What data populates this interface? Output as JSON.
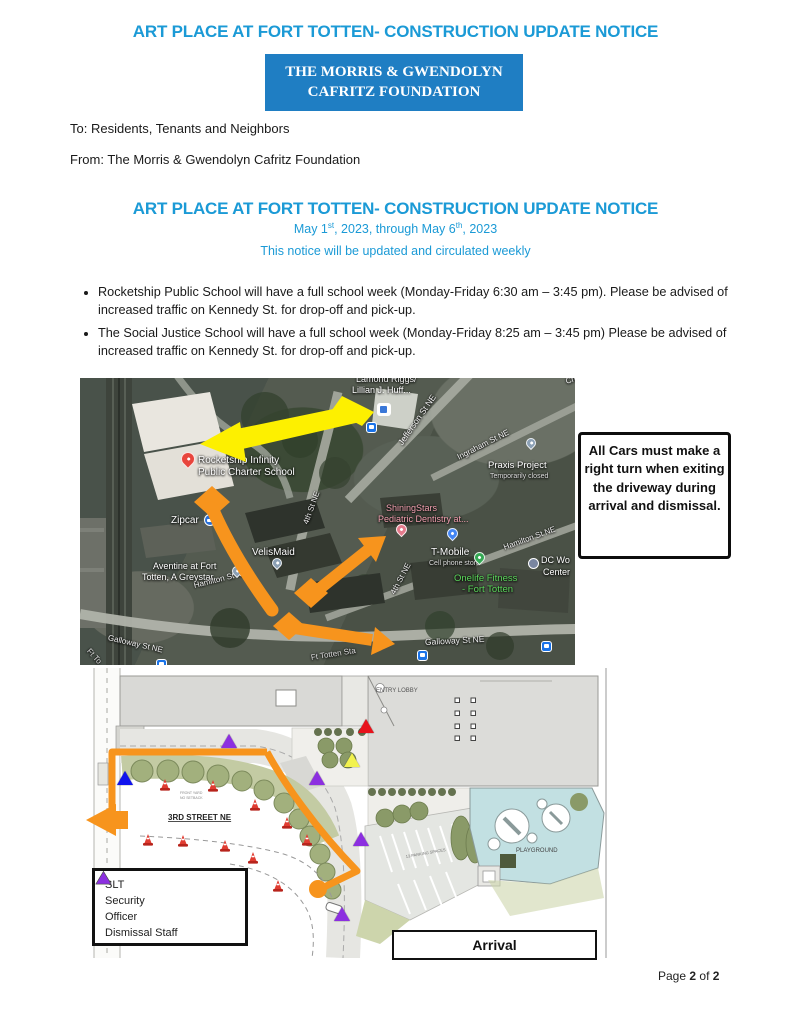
{
  "doc": {
    "title": "ART PLACE AT FORT TOTTEN- CONSTRUCTION UPDATE NOTICE"
  },
  "header": {
    "org_line1": "THE MORRIS & GWENDOLYN",
    "org_line2": "CAFRITZ FOUNDATION",
    "to_line": "To: Residents, Tenants and Neighbors",
    "from_line": "From: The Morris & Gwendolyn Cafritz Foundation"
  },
  "notice": {
    "date": {
      "p1": "May 1",
      "s1": "st",
      "p2": ", 2023, through May 6",
      "s2": "th",
      "p3": ", 2023"
    },
    "subtitle": "This notice will be updated and circulated weekly"
  },
  "bullets": [
    "Rocketship Public School will have a full school week (Monday-Friday 6:30 am – 3:45 pm). Please be advised of increased traffic on Kennedy St. for drop-off and pick-up.",
    "The Social Justice School will have a full school week (Monday-Friday 8:25 am – 3:45 pm) Please be advised of increased traffic on Kennedy St. for drop-off and pick-up."
  ],
  "colors": {
    "title_blue": "#1B9AD6",
    "banner_blue": "#1F7EC3",
    "route_orange": "#F7941D",
    "route_yellow": "#FDF000",
    "playground_blue": "#C2E0E2"
  },
  "map": {
    "labels": [
      {
        "text": "Lamond Riggs/",
        "x": 276,
        "y": -3,
        "size": 9,
        "color": "#f2f2f2"
      },
      {
        "text": "Lillian J. Huff...",
        "x": 272,
        "y": 8,
        "size": 9,
        "color": "#fff"
      },
      {
        "text": "Jefferson St NE",
        "x": 320,
        "y": 62,
        "size": 8.5,
        "color": "#f2f2f2",
        "rotate": -55
      },
      {
        "text": "Ingraham St NE",
        "x": 378,
        "y": 76,
        "size": 8,
        "color": "#f2f2f2",
        "rotate": -27
      },
      {
        "text": "Praxis Project",
        "x": 408,
        "y": 83,
        "size": 9.5,
        "color": "#fff"
      },
      {
        "text": "Temporarily closed",
        "x": 410,
        "y": 95,
        "size": 7,
        "color": "#ddd"
      },
      {
        "text": "Chil",
        "x": 486,
        "y": 0,
        "size": 8,
        "color": "#eee",
        "rotate": -18
      },
      {
        "text": "Rocketship Infinity",
        "x": 118,
        "y": 78,
        "size": 10,
        "color": "#fff"
      },
      {
        "text": "Public Charter School",
        "x": 118,
        "y": 90,
        "size": 10,
        "color": "#fff"
      },
      {
        "text": "Zipcar",
        "x": 91,
        "y": 138,
        "size": 10,
        "color": "#fff"
      },
      {
        "text": "VelisMaid",
        "x": 172,
        "y": 170,
        "size": 10,
        "color": "#fff"
      },
      {
        "text": "Aventine at Fort",
        "x": 73,
        "y": 184,
        "size": 9,
        "color": "#fff"
      },
      {
        "text": "Totten, A Greystar...",
        "x": 62,
        "y": 195,
        "size": 9,
        "color": "#fff"
      },
      {
        "text": "ShiningStars",
        "x": 306,
        "y": 126,
        "size": 9,
        "color": "#F2A0B0"
      },
      {
        "text": "Pediatric Dentistry at...",
        "x": 298,
        "y": 137,
        "size": 9,
        "color": "#F2A0B0"
      },
      {
        "text": "4th St NE",
        "x": 226,
        "y": 142,
        "size": 8,
        "color": "#eee",
        "rotate": -70
      },
      {
        "text": "4th St NE",
        "x": 313,
        "y": 212,
        "size": 8,
        "color": "#eee",
        "rotate": -62
      },
      {
        "text": "T-Mobile",
        "x": 351,
        "y": 170,
        "size": 10,
        "color": "#fff"
      },
      {
        "text": "Cell phone store",
        "x": 349,
        "y": 182,
        "size": 7,
        "color": "#ddd"
      },
      {
        "text": "Onelife Fitness",
        "x": 374,
        "y": 196,
        "size": 9.5,
        "color": "#5BD75B"
      },
      {
        "text": "- Fort Totten",
        "x": 382,
        "y": 207,
        "size": 9.5,
        "color": "#5BD75B"
      },
      {
        "text": "DC Wo",
        "x": 461,
        "y": 178,
        "size": 9,
        "color": "#fff"
      },
      {
        "text": "Center",
        "x": 463,
        "y": 190,
        "size": 9,
        "color": "#fff"
      },
      {
        "text": "Hamilton St NE",
        "x": 424,
        "y": 166,
        "size": 8,
        "color": "#f2f2f2",
        "rotate": -20
      },
      {
        "text": "Hamilton St NE",
        "x": 114,
        "y": 204,
        "size": 8,
        "color": "#f2f2f2",
        "rotate": -14
      },
      {
        "text": "Galloway St NE",
        "x": 28,
        "y": 256,
        "size": 8,
        "color": "#f2f2f2",
        "rotate": 13
      },
      {
        "text": "Galloway St NE",
        "x": 345,
        "y": 260,
        "size": 8.5,
        "color": "#f2f2f2",
        "rotate": -3
      },
      {
        "text": "Ft Totten Sta",
        "x": 231,
        "y": 276,
        "size": 8,
        "color": "#ddd",
        "rotate": -9
      },
      {
        "text": "Ft To",
        "x": 8,
        "y": 268,
        "size": 8,
        "color": "#ddd",
        "rotate": 48
      }
    ],
    "pins": [
      {
        "name": "rocketship-pin",
        "color": "#E8453C",
        "x": 101,
        "y": 74,
        "size": 14
      },
      {
        "name": "praxis-pin",
        "color": "#8ba0b5",
        "x": 446,
        "y": 60,
        "size": 10
      },
      {
        "name": "velismaid-pin",
        "color": "#8ba0b5",
        "x": 192,
        "y": 180,
        "size": 10
      },
      {
        "name": "aventine-pin",
        "color": "#8ba0b5",
        "x": 152,
        "y": 188,
        "size": 10
      },
      {
        "name": "dentistry-pin",
        "color": "#E57B8C",
        "x": 316,
        "y": 146,
        "size": 11
      },
      {
        "name": "tmobile-pin",
        "color": "#4285F4",
        "x": 367,
        "y": 150,
        "size": 11
      },
      {
        "name": "onelife-pin",
        "color": "#34A853",
        "x": 394,
        "y": 174,
        "size": 11
      }
    ],
    "icons": [
      {
        "type": "library",
        "name": "library-icon",
        "x": 297,
        "y": 25
      },
      {
        "type": "bus",
        "name": "bus-stop-icon",
        "x": 286,
        "y": 44
      },
      {
        "type": "zipcar",
        "name": "zipcar-icon",
        "x": 124,
        "y": 136
      },
      {
        "type": "metro",
        "name": "metro-icon",
        "x": 448,
        "y": 180
      },
      {
        "type": "bus",
        "name": "bus-stop-icon",
        "x": 337,
        "y": 272
      },
      {
        "type": "bus",
        "name": "bus-stop-icon",
        "x": 461,
        "y": 263
      },
      {
        "type": "bus",
        "name": "bus-stop-icon",
        "x": 76,
        "y": 281
      }
    ]
  },
  "callout": {
    "text": "All Cars must make a right turn when exiting the driveway during arrival and dismissal."
  },
  "siteplan": {
    "labels": {
      "entry_lobby": "ENTRY LOBBY",
      "street": "3RD STREET NE",
      "playground": "PLAYGROUND",
      "parking": "13 PARKING SPACES",
      "front_yard1": "FRONT YARD",
      "front_yard2": "NO SETBACK"
    },
    "legend": [
      {
        "label": "SLT",
        "color": "#F2F24E"
      },
      {
        "label": "Security",
        "color": "#E8131C"
      },
      {
        "label": "Officer",
        "color": "#1013EE"
      },
      {
        "label": "Dismissal Staff",
        "color": "#8C2FE0"
      }
    ],
    "markers": [
      {
        "color": "#8C2FE0",
        "x": 149,
        "y": 73
      },
      {
        "color": "#E8131C",
        "x": 286,
        "y": 58
      },
      {
        "color": "#F2F24E",
        "x": 272,
        "y": 92
      },
      {
        "color": "#8C2FE0",
        "x": 237,
        "y": 110
      },
      {
        "color": "#1013EE",
        "x": 45,
        "y": 110
      },
      {
        "color": "#8C2FE0",
        "x": 281,
        "y": 171
      },
      {
        "color": "#8C2FE0",
        "x": 262,
        "y": 246
      }
    ],
    "cones": [
      {
        "x": 85,
        "y": 117
      },
      {
        "x": 133,
        "y": 118
      },
      {
        "x": 175,
        "y": 137
      },
      {
        "x": 207,
        "y": 155
      },
      {
        "x": 227,
        "y": 172
      },
      {
        "x": 68,
        "y": 172
      },
      {
        "x": 103,
        "y": 173
      },
      {
        "x": 145,
        "y": 178
      },
      {
        "x": 173,
        "y": 190
      },
      {
        "x": 198,
        "y": 218
      }
    ],
    "arrival": "Arrival"
  },
  "footer": {
    "page_word": "Page",
    "page_num": "2",
    "of_word": "of",
    "total": "2"
  }
}
